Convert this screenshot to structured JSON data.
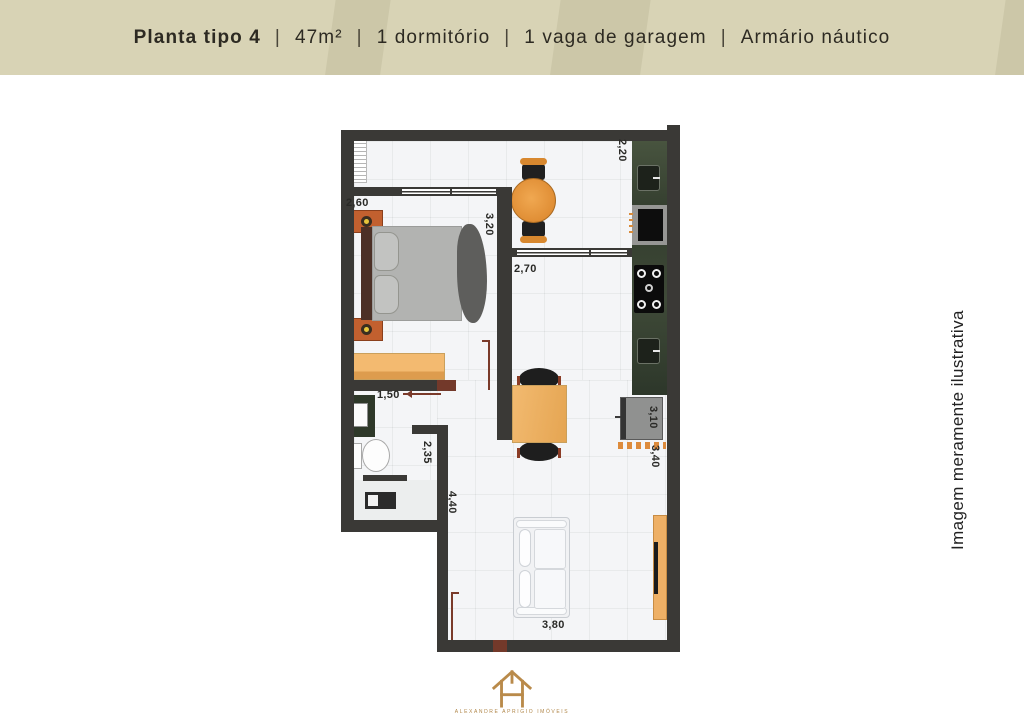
{
  "header": {
    "title": "Planta tipo 4",
    "separator": "|",
    "specs": [
      "47m²",
      "1 dormitório",
      "1 vaga de garagem",
      "Armário náutico"
    ]
  },
  "plan": {
    "dimensions": [
      {
        "id": "bedroom-width",
        "value": "2,60"
      },
      {
        "id": "bedroom-length",
        "value": "3,20"
      },
      {
        "id": "balcony-depth",
        "value": "2,20"
      },
      {
        "id": "kitchen-width",
        "value": "2,70"
      },
      {
        "id": "bathroom-width",
        "value": "1,50"
      },
      {
        "id": "bathroom-length",
        "value": "2,35"
      },
      {
        "id": "living-length",
        "value": "4,40"
      },
      {
        "id": "service-width",
        "value": "3,10"
      },
      {
        "id": "service-length",
        "value": "3,40"
      },
      {
        "id": "living-width",
        "value": "3,80"
      }
    ]
  },
  "side_note": "Imagem meramente ilustrativa",
  "logo": {
    "brand": "ALEXANDRE APRIGIO IMÓVEIS"
  },
  "colors": {
    "header_bg": "#d8d3b5",
    "wall": "#3a3936",
    "counter_green": "#3c4636",
    "furniture_wood": "#e8973e",
    "door_red": "#7a3a2a",
    "logo_gold": "#b98a4a"
  }
}
